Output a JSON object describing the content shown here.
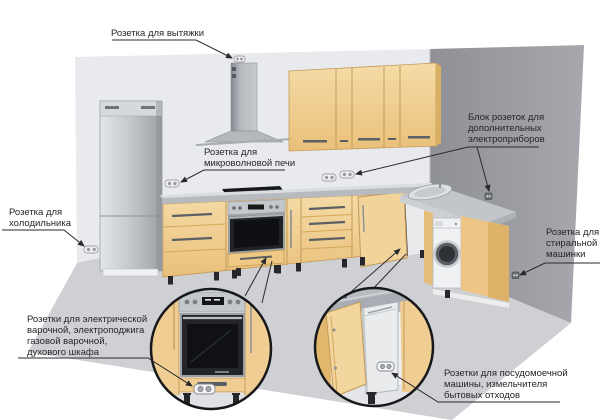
{
  "diagram": {
    "type": "kitchen-outlet-placement-diagram",
    "callouts": {
      "hood": "Розетка для вытяжки",
      "microwave": "Розетка для\nмикроволновой печи",
      "appliance_block": "Блок розеток для\nдополнительных\nэлектроприборов",
      "fridge": "Розетка для\nхолодильника",
      "washing_machine": "Розетка для\nстиральной\nмашинки",
      "cooktop_oven": "Розетки для электрической\nварочной, электроподжига\nгазовой варочной,\nдухового шкафа",
      "dishwasher_disposal": "Розетки для посудомоечной\nмашины, измельчителя\nбытовых отходов"
    },
    "icons": {
      "outlet": "double-socket-icon",
      "magnifier_inset_left": "oven-closeup-circle",
      "magnifier_inset_right": "cabinet-closeup-circle"
    },
    "colors": {
      "wall_left": "#e9eaee",
      "wall_right": "#999aa1",
      "floor": "#cfd0d4",
      "cabinet_face": "#f0cd92",
      "cabinet_shade": "#deb269",
      "counter": "#b7bbc0",
      "steel": "#c3c8cc",
      "appliance_white": "#f0f1f3",
      "leader_line": "#2a2a2e"
    }
  }
}
